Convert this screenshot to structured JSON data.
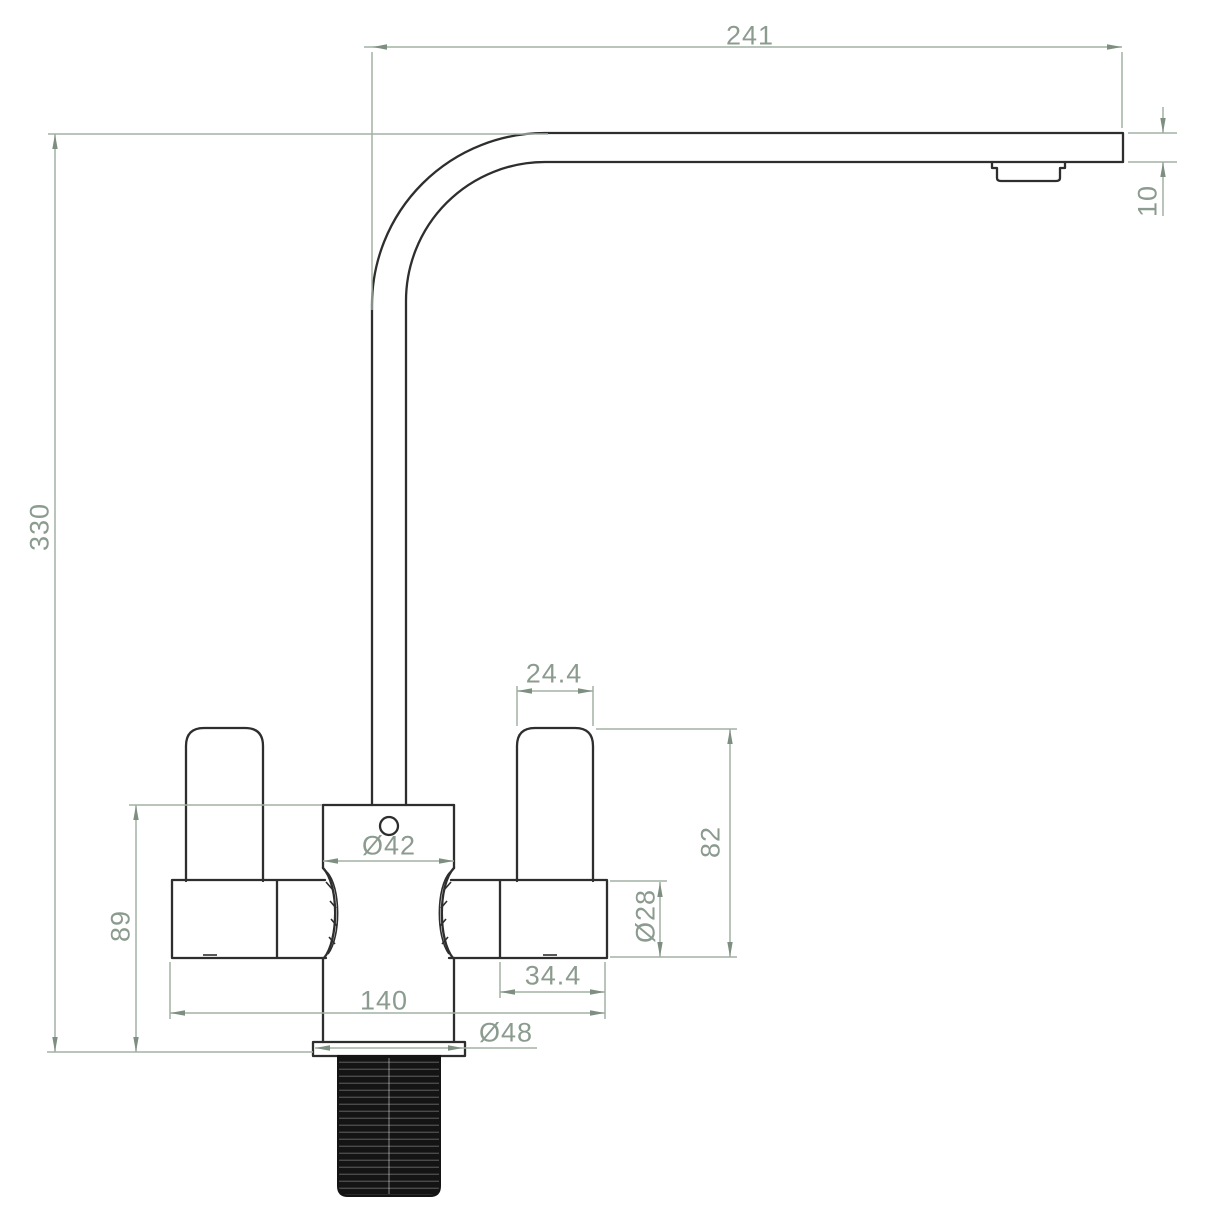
{
  "drawing": {
    "subject": "Kitchen mixer tap — dimensioned side elevation",
    "dimensions": {
      "spout_reach": "241",
      "spout_tube_height": "10",
      "overall_height": "330",
      "handle_width": "24.4",
      "handle_height": "82",
      "handle_barrel_diameter": "Ø28",
      "body_diameter": "Ø42",
      "handle_barrel_length": "34.4",
      "overall_width": "140",
      "base_flange_diameter": "Ø48",
      "body_height": "89"
    },
    "colors": {
      "line_color": "#2e2e2e",
      "dimension_line_color": "#a2b0a3",
      "dimension_text_color": "#8c9b8f",
      "arrow_color": "#7e8f81",
      "thread_color": "#141414",
      "background": "#ffffff"
    }
  }
}
